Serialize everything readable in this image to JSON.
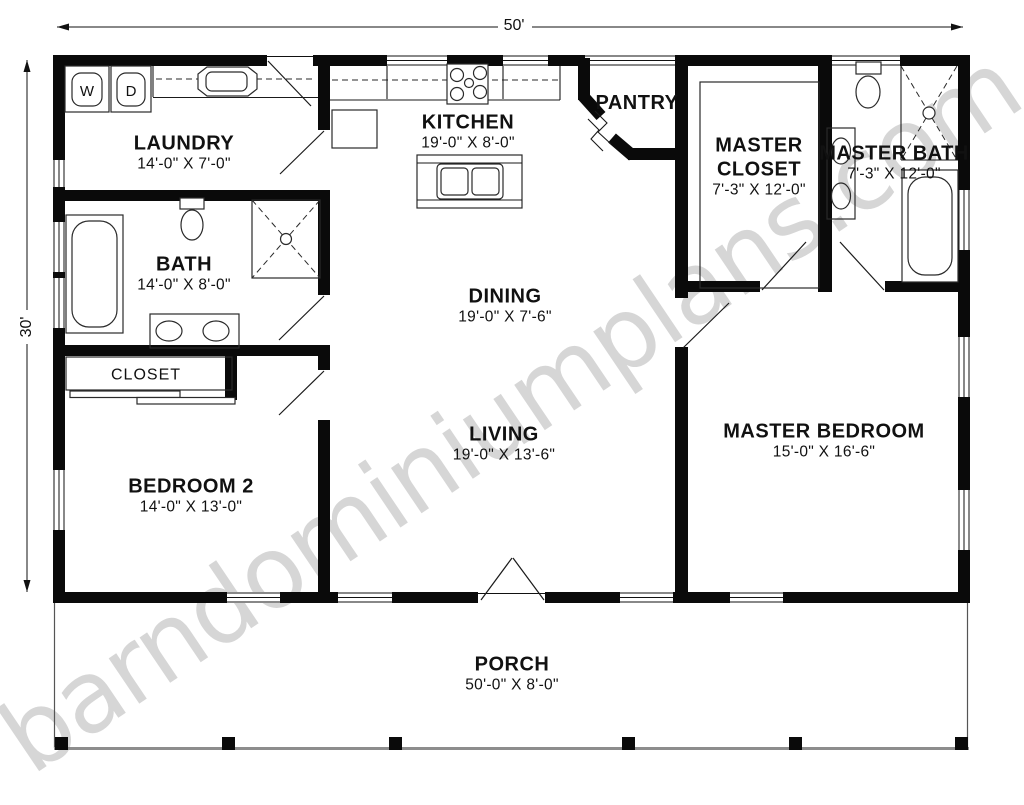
{
  "watermark": "barndominiumplans.com",
  "overall_dimensions": {
    "top": "50'",
    "left": "30'"
  },
  "rooms": {
    "laundry": {
      "name": "LAUNDRY",
      "size": "14'-0\" X 7'-0\""
    },
    "kitchen": {
      "name": "KITCHEN",
      "size": "19'-0\" X 8'-0\""
    },
    "pantry": {
      "name": "PANTRY"
    },
    "master_closet": {
      "name": "MASTER CLOSET",
      "size": "7'-3\" X 12'-0\""
    },
    "master_bath": {
      "name": "MASTER BATH",
      "size": "7'-3\" X 12'-0\""
    },
    "bath": {
      "name": "BATH",
      "size": "14'-0\" X 8'-0\""
    },
    "closet": {
      "name": "CLOSET"
    },
    "dining": {
      "name": "DINING",
      "size": "19'-0\" X 7'-6\""
    },
    "living": {
      "name": "LIVING",
      "size": "19'-0\" X 13'-6\""
    },
    "bedroom2": {
      "name": "BEDROOM 2",
      "size": "14'-0\" X 13'-0\""
    },
    "master_bedroom": {
      "name": "MASTER BEDROOM",
      "size": "15'-0\" X 16'-6\""
    },
    "porch": {
      "name": "PORCH",
      "size": "50'-0\" X 8'-0\""
    }
  },
  "fixtures": {
    "washer": "W",
    "dryer": "D"
  },
  "colors": {
    "wall": "#0a0a0a",
    "porch_edge": "#8d8d8d",
    "watermark_gray": "#cfcfcf"
  }
}
